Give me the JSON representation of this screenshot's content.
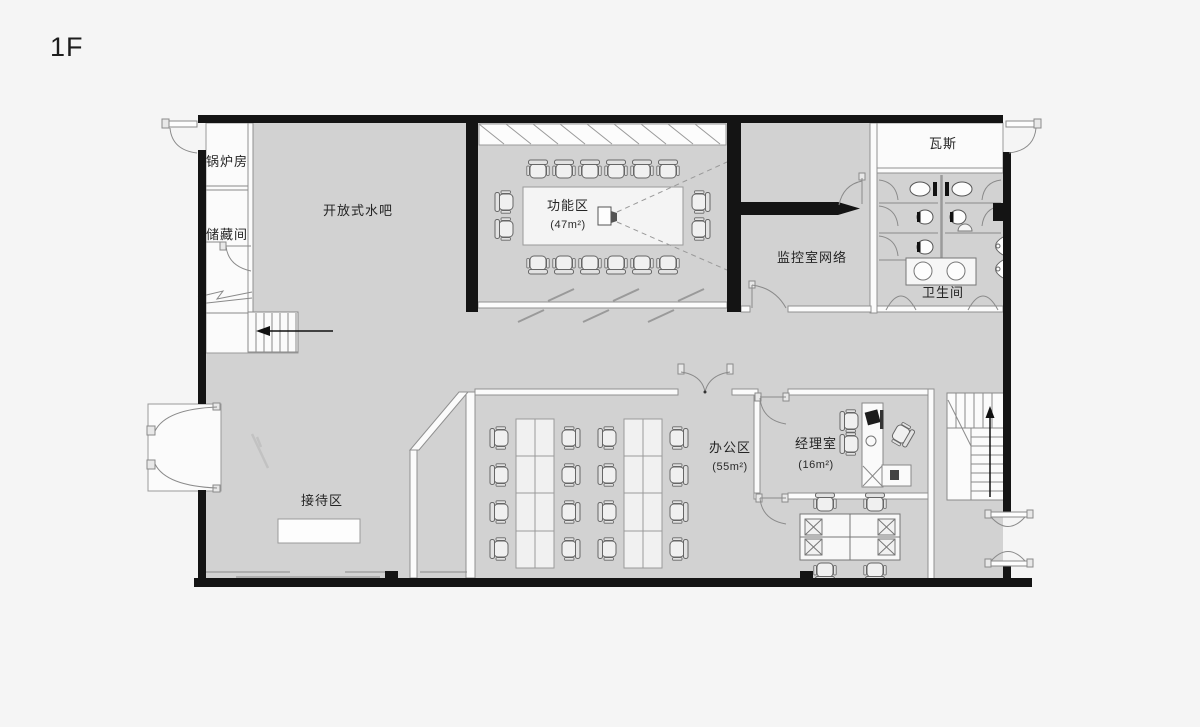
{
  "page": {
    "floor_label": "1F"
  },
  "rooms": {
    "boiler": "锅炉房",
    "storage": "储藏间",
    "water_bar": "开放式水吧",
    "function_area": {
      "name": "功能区",
      "area": "(47m²)"
    },
    "gas": "瓦斯",
    "monitor": "监控室网络",
    "restroom": "卫生间",
    "reception": "接待区",
    "office": {
      "name": "办公区",
      "area": "(55m²)"
    },
    "manager": {
      "name": "经理室",
      "area": "(16m²)"
    }
  }
}
